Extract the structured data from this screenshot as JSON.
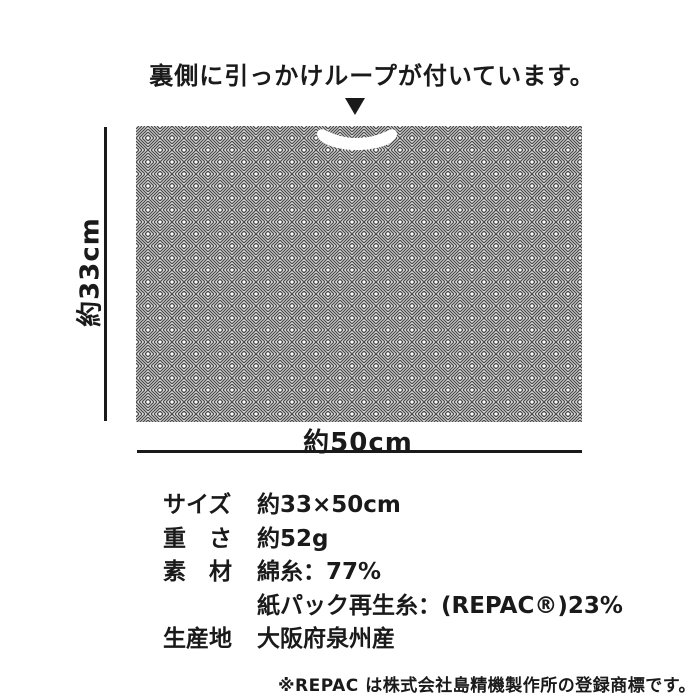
{
  "colors": {
    "text": "#1a1a1a",
    "weave_stroke": "#4b4b4b",
    "background": "#ffffff"
  },
  "annotation": {
    "loop_note": "裏側に引っかけループが付いています。"
  },
  "icons": {
    "pointer": "▼ (down-triangle-icon)",
    "cloth_texture": "basketweave-pattern",
    "hanging_loop": "white-loop-cutout"
  },
  "diagram": {
    "height_label": "約33cm",
    "width_label": "約50cm"
  },
  "specs": {
    "rows": [
      {
        "label": "サイズ",
        "value": "約33×50cm"
      },
      {
        "label": "重　さ",
        "value": "約52g"
      },
      {
        "label": "素　材",
        "value": "綿糸：77%"
      },
      {
        "label": "",
        "value": "紙パック再生糸：(REPAC®)23%"
      },
      {
        "label": "生産地",
        "value": "大阪府泉州産"
      }
    ]
  },
  "footnote": "※REPAC は株式会社島精機製作所の登録商標です。"
}
